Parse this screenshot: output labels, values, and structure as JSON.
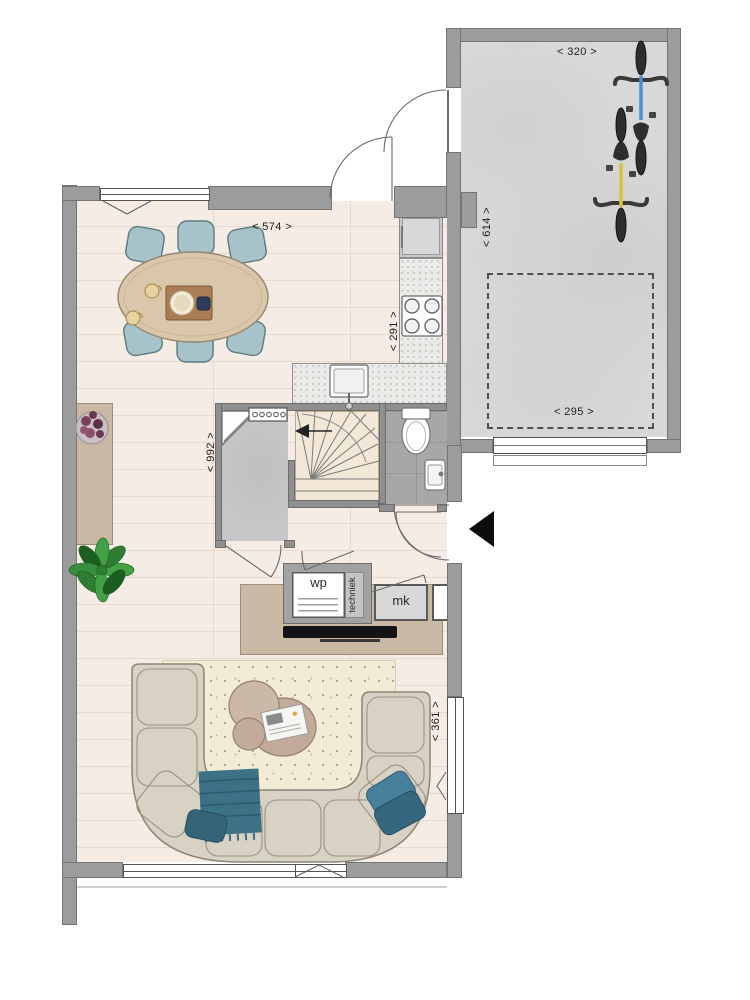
{
  "dimensions": {
    "living_width": "< 574 >",
    "kitchen_depth": "< 291 >",
    "living_length": "< 992 >",
    "living_window": "< 361 >",
    "garage_width": "< 320 >",
    "garage_length": "< 614 >",
    "garage_entry": "< 295 >"
  },
  "rooms": {
    "heat_pump": "wp",
    "meter_cupboard": "mk",
    "technical": "techniek"
  },
  "colors": {
    "wall": "#9c9c9c",
    "interior_wall": "#8f8f8f",
    "wood_floor": "#f4eae4",
    "concrete_floor": "#d8d8d8",
    "hall_floor": "#c7c7c9",
    "tile_floor": "#a7a7a7",
    "stairs_floor": "#f3e8d7",
    "counter": "#ebebe9",
    "cabinet": "#c9b8a3",
    "dining_table": "#dac7ab",
    "chair": "#a5c3c8",
    "sofa": "#d8d2c5",
    "rug": "#f2ebd6",
    "textile_accent": "#3d7186",
    "plant": "#2e7d32",
    "bike_blue": "#4a8fd3",
    "bike_yellow": "#d4c33e"
  }
}
